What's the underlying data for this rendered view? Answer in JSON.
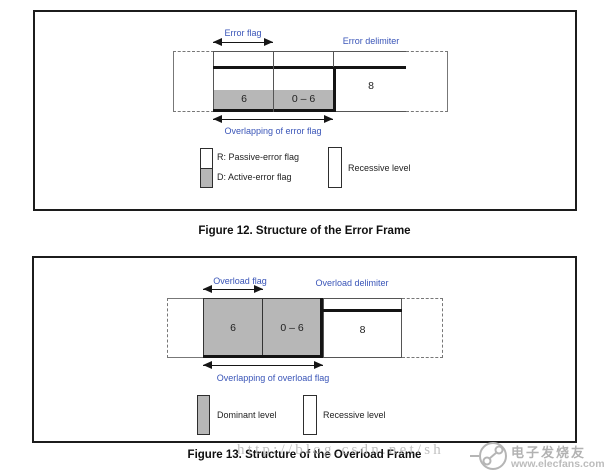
{
  "colors": {
    "label_blue": "#3a55b8",
    "dominant_gray": "#b7b7b7",
    "signal_black": "#141414"
  },
  "figure_error": {
    "flag_label": "Error flag",
    "delimiter_label": "Error delimiter",
    "overlap_label": "Overlapping of error flag",
    "cells": {
      "flag_bits": "6",
      "echo_bits": "0 – 6",
      "delimiter_bits": "8"
    },
    "legend": {
      "passive_label": "R: Passive-error flag",
      "active_label": "D: Active-error flag",
      "recessive_label": "Recessive level"
    },
    "caption": "Figure 12. Structure of the Error Frame"
  },
  "figure_overload": {
    "flag_label": "Overload flag",
    "delimiter_label": "Overload delimiter",
    "overlap_label": "Overlapping of overload flag",
    "cells": {
      "flag_bits": "6",
      "echo_bits": "0 – 6",
      "delimiter_bits": "8"
    },
    "legend": {
      "dominant_label": "Dominant level",
      "recessive_label": "Recessive level"
    },
    "caption": "Figure 13. Structure of the Overload Frame"
  },
  "watermark": {
    "url_text": "http://blog.csdn.net/sh",
    "site_name": "电子发烧友",
    "site_url": "www.elecfans.com"
  }
}
